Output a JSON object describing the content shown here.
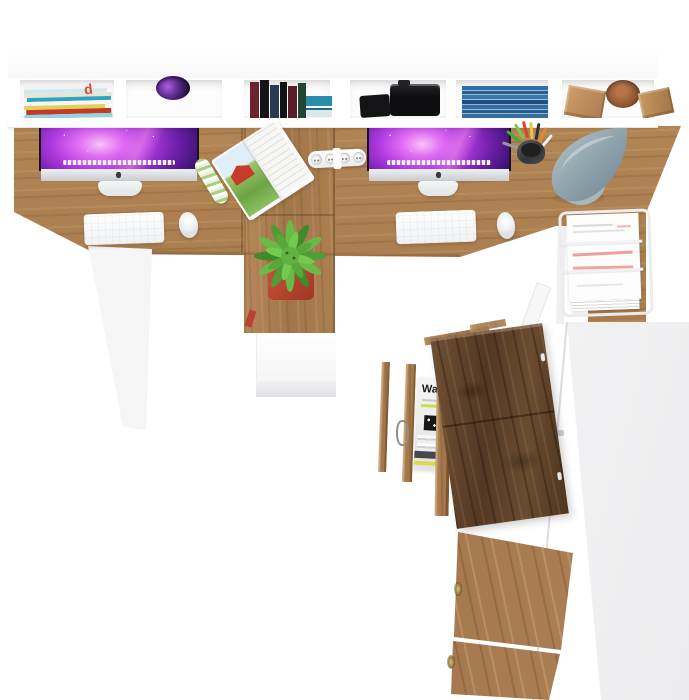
{
  "scene": {
    "type": "product-photo",
    "subject": "Two-person office desk set with hutch, open cabinet and drawers",
    "view": "top-down"
  },
  "texts": {
    "drawer_magazine_title": "Wa",
    "shelf_magazine_letter": "d"
  },
  "palette": {
    "background": "#ffffff",
    "oak_light": "#c49a68",
    "oak_mid": "#a87c4e",
    "oak_shadow": "#7d5a36",
    "dark_walnut": "#5f4128",
    "white_furniture": "#fbfbfc",
    "furniture_shadow": "#e8e8ea",
    "screen_magenta": "#d254ee",
    "screen_deep_purple": "#2a0c60",
    "plant_green": "#5cb53e",
    "pot_terracotta": "#c1492f",
    "lamp_gray": "#93a5ad",
    "accent_red": "#c13a2b",
    "dvd_blue": "#2d6fa6"
  },
  "hutch": {
    "compartments": [
      {
        "name": "magazine-stack",
        "contents": "flat stack of colourful magazines"
      },
      {
        "name": "cable-grommet",
        "contents": "round cable hole glowing purple"
      },
      {
        "name": "book-row",
        "contents": "standing books maroon/black/navy/green, teal books lying flat"
      },
      {
        "name": "camera",
        "contents": "black camera body and lens"
      },
      {
        "name": "dvd-stack",
        "contents": "stack of blue DVD cases"
      },
      {
        "name": "decor-blocks",
        "contents": "wooden blocks and a turned bowl"
      }
    ]
  },
  "desk": {
    "left": {
      "objects": [
        "iMac with purple galaxy wallpaper",
        "white keyboard",
        "white mouse",
        "open farm magazine with red barn",
        "rolled magazine"
      ]
    },
    "right": {
      "objects": [
        "iMac with purple galaxy wallpaper",
        "white keyboard",
        "white mouse",
        "white power strip",
        "pencil cup with coloured pencils",
        "grey cone desk lamp"
      ]
    },
    "returns": [
      "potted green plant in terracotta pot on left return",
      "white wire paper tray with red-lined documents on right return"
    ]
  },
  "cabinets": {
    "middle": "white pedestal below plant return",
    "right": {
      "state": "open",
      "parts": [
        "dark oak door swung open",
        "open drawer holding magazines",
        "light oak lower doors with brass knobs",
        "tall white side panel"
      ]
    }
  }
}
